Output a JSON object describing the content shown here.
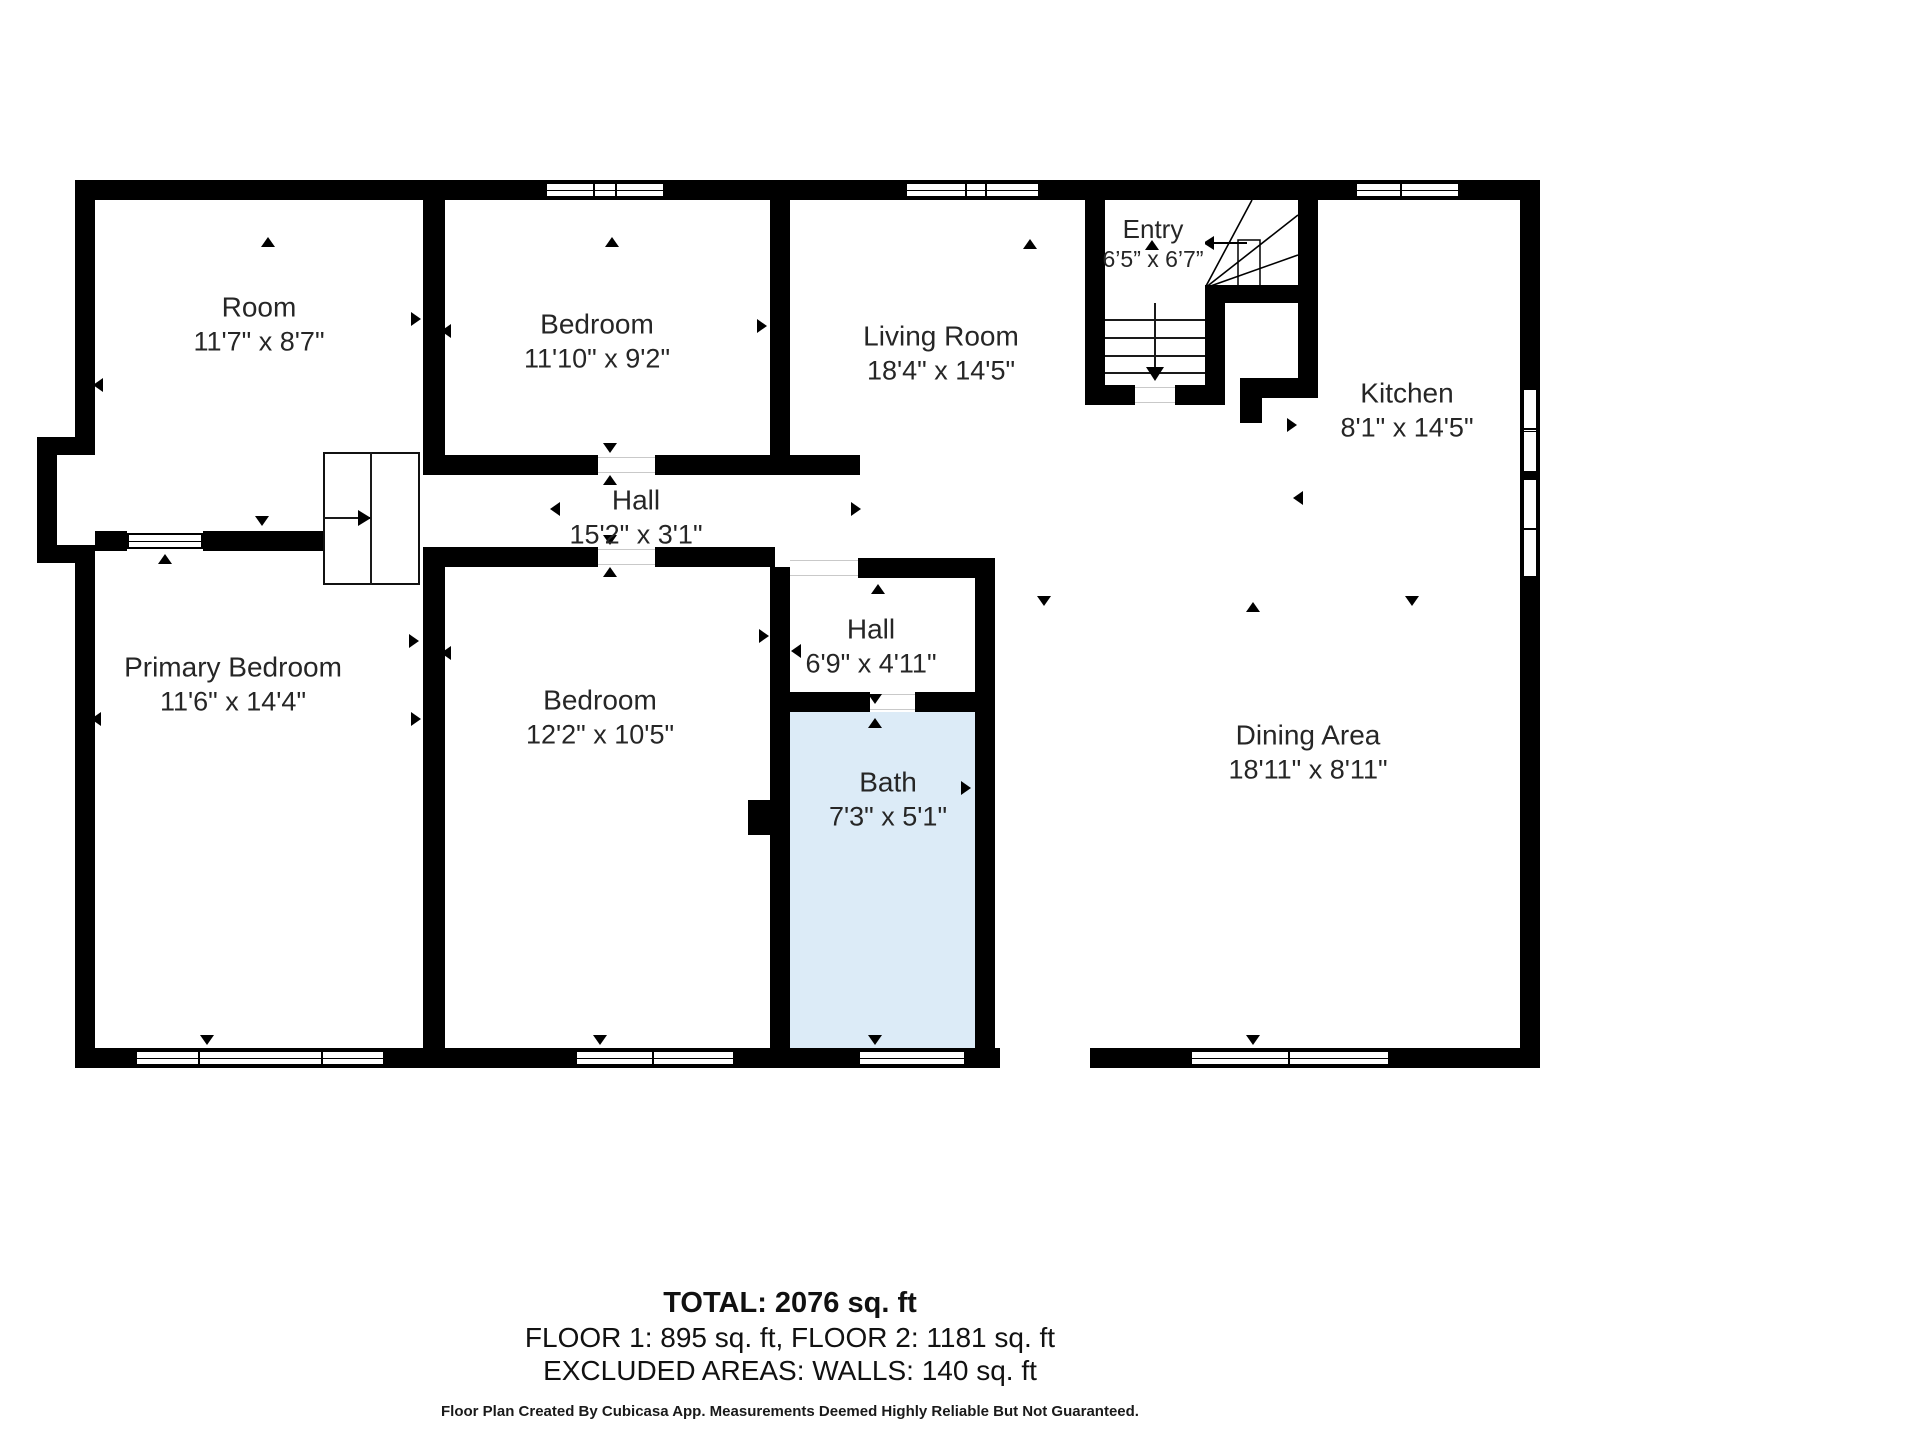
{
  "floorplan": {
    "colors": {
      "wall": "#000000",
      "bath_fill": "#dcebf7",
      "text": "#262626"
    },
    "rooms": [
      {
        "id": "room",
        "name": "Room",
        "dims": "11'7\" x 8'7\"",
        "cx": 259,
        "cy": 324,
        "small": false
      },
      {
        "id": "bedroom-top",
        "name": "Bedroom",
        "dims": "11'10\" x 9'2\"",
        "cx": 597,
        "cy": 341,
        "small": false
      },
      {
        "id": "living-room",
        "name": "Living Room",
        "dims": "18'4\" x 14'5\"",
        "cx": 941,
        "cy": 353,
        "small": false
      },
      {
        "id": "entry",
        "name": "Entry",
        "dims": "6’5” x 6’7”",
        "cx": 1153,
        "cy": 244,
        "small": true
      },
      {
        "id": "kitchen",
        "name": "Kitchen",
        "dims": "8'1\" x 14'5\"",
        "cx": 1407,
        "cy": 410,
        "small": false
      },
      {
        "id": "hall-main",
        "name": "Hall",
        "dims": "15'2\" x 3'1\"",
        "cx": 636,
        "cy": 517,
        "small": false
      },
      {
        "id": "primary-bedroom",
        "name": "Primary Bedroom",
        "dims": "11'6\" x 14'4\"",
        "cx": 233,
        "cy": 684,
        "small": false
      },
      {
        "id": "bedroom-bottom",
        "name": "Bedroom",
        "dims": "12'2\" x 10'5\"",
        "cx": 600,
        "cy": 717,
        "small": false
      },
      {
        "id": "hall-small",
        "name": "Hall",
        "dims": "6'9\" x 4'11\"",
        "cx": 871,
        "cy": 646,
        "small": false
      },
      {
        "id": "bath",
        "name": "Bath",
        "dims": "7'3\" x 5'1\"",
        "cx": 888,
        "cy": 799,
        "small": false
      },
      {
        "id": "dining-area",
        "name": "Dining Area",
        "dims": "18'11\" x 8'11\"",
        "cx": 1308,
        "cy": 752,
        "small": false
      }
    ],
    "door_markers": [
      {
        "d": "up",
        "x": 268,
        "y": 243
      },
      {
        "d": "up",
        "x": 612,
        "y": 243
      },
      {
        "d": "up",
        "x": 1030,
        "y": 245
      },
      {
        "d": "up",
        "x": 1152,
        "y": 246
      },
      {
        "d": "up",
        "x": 610,
        "y": 481
      },
      {
        "d": "up",
        "x": 610,
        "y": 573
      },
      {
        "d": "up",
        "x": 165,
        "y": 560
      },
      {
        "d": "up",
        "x": 878,
        "y": 590
      },
      {
        "d": "up",
        "x": 875,
        "y": 724
      },
      {
        "d": "up",
        "x": 1253,
        "y": 608
      },
      {
        "d": "down",
        "x": 610,
        "y": 449
      },
      {
        "d": "down",
        "x": 610,
        "y": 541
      },
      {
        "d": "down",
        "x": 262,
        "y": 522
      },
      {
        "d": "down",
        "x": 207,
        "y": 1041
      },
      {
        "d": "down",
        "x": 600,
        "y": 1041
      },
      {
        "d": "down",
        "x": 875,
        "y": 700
      },
      {
        "d": "down",
        "x": 875,
        "y": 1041
      },
      {
        "d": "down",
        "x": 1044,
        "y": 602
      },
      {
        "d": "down",
        "x": 1412,
        "y": 602
      },
      {
        "d": "down",
        "x": 1253,
        "y": 1041
      },
      {
        "d": "left",
        "x": 100,
        "y": 384
      },
      {
        "d": "left",
        "x": 448,
        "y": 330
      },
      {
        "d": "left",
        "x": 1096,
        "y": 243
      },
      {
        "d": "left",
        "x": 557,
        "y": 508
      },
      {
        "d": "left",
        "x": 98,
        "y": 718
      },
      {
        "d": "left",
        "x": 448,
        "y": 652
      },
      {
        "d": "left",
        "x": 798,
        "y": 650
      },
      {
        "d": "left",
        "x": 777,
        "y": 787
      },
      {
        "d": "left",
        "x": 1300,
        "y": 497
      },
      {
        "d": "right",
        "x": 418,
        "y": 318
      },
      {
        "d": "right",
        "x": 764,
        "y": 325
      },
      {
        "d": "right",
        "x": 858,
        "y": 508
      },
      {
        "d": "right",
        "x": 418,
        "y": 718
      },
      {
        "d": "right",
        "x": 416,
        "y": 640
      },
      {
        "d": "right",
        "x": 766,
        "y": 635
      },
      {
        "d": "right",
        "x": 968,
        "y": 787
      },
      {
        "d": "right",
        "x": 1294,
        "y": 424
      },
      {
        "d": "right",
        "x": 1529,
        "y": 1000
      }
    ]
  },
  "footer": {
    "total": "TOTAL: 2076 sq. ft",
    "floors": "FLOOR 1: 895 sq. ft, FLOOR 2: 1181 sq. ft",
    "excluded": "EXCLUDED AREAS: WALLS: 140 sq. ft",
    "disclaimer": "Floor Plan Created By Cubicasa App. Measurements Deemed Highly Reliable But Not Guaranteed."
  }
}
